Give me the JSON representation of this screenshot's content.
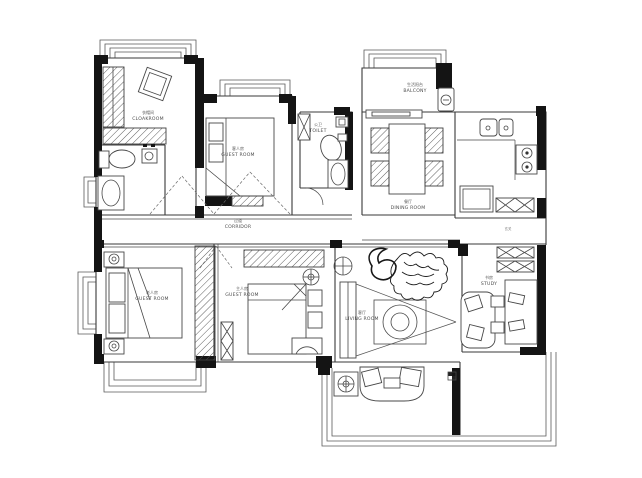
{
  "page": {
    "background": "#ffffff"
  },
  "plan": {
    "line_color": "#3a3a3a",
    "wall_block_color": "#141414",
    "label_color": "#4d4d4d"
  },
  "rooms": {
    "cloakroom": {
      "zh": "衣帽间",
      "en": "CLOAKROOM"
    },
    "guest_room_top": {
      "zh": "客人房",
      "en": "GUEST ROOM"
    },
    "toilet": {
      "zh": "公卫",
      "en": "TOILET"
    },
    "balcony_top": {
      "zh": "生活阳台",
      "en": "BALCONY"
    },
    "dining_room": {
      "zh": "餐厅",
      "en": "DINING ROOM"
    },
    "kitchen": {
      "zh": "",
      "en": ""
    },
    "corridor": {
      "zh": "过道",
      "en": "CORRIDOR"
    },
    "guest_room_left": {
      "zh": "老人房",
      "en": "GUEST ROOM"
    },
    "guest_room_mid": {
      "zh": "主人房",
      "en": "GUEST ROOM"
    },
    "living_room": {
      "zh": "客厅",
      "en": "LIVING ROOM"
    },
    "study": {
      "zh": "书房",
      "en": "STUDY"
    },
    "entry": {
      "zh": "玄关",
      "en": ""
    }
  }
}
